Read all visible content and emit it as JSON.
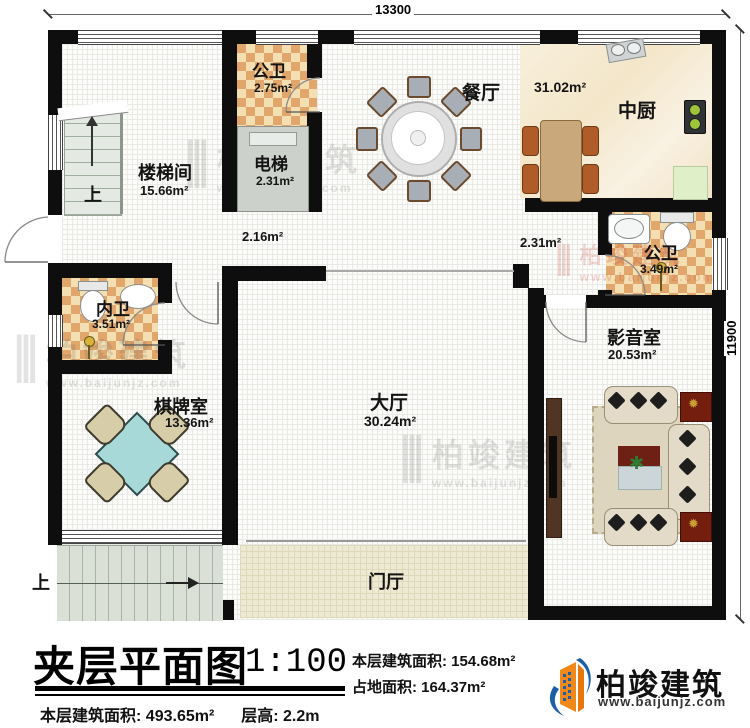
{
  "plan": {
    "dim_top": "13300",
    "dim_right": "11900",
    "up_label": "上",
    "rooms": [
      {
        "name": "楼梯间",
        "area": "15.66m²"
      },
      {
        "name": "公卫",
        "area": "2.75m²"
      },
      {
        "name": "电梯",
        "area": "2.31m²"
      },
      {
        "name": "餐厅",
        "area": "31.02m²"
      },
      {
        "name": "中厨",
        "area": ""
      },
      {
        "name": "",
        "area": "2.16m²"
      },
      {
        "name": "",
        "area": "2.31m²"
      },
      {
        "name": "公卫",
        "area": "3.49m²"
      },
      {
        "name": "内卫",
        "area": "3.51m²"
      },
      {
        "name": "棋牌室",
        "area": "13.36m²"
      },
      {
        "name": "大厅",
        "area": "30.24m²"
      },
      {
        "name": "影音室",
        "area": "20.53m²"
      },
      {
        "name": "门厅",
        "area": ""
      }
    ]
  },
  "watermark": {
    "text": "柏竣建筑",
    "url": "www.baijunjz.com"
  },
  "footer": {
    "title": "夹层平面图",
    "scale": "1:100",
    "floor_area_label": "本层建筑面积:",
    "floor_area_value": "154.68m²",
    "site_area_label": "占地面积:",
    "site_area_value": "164.37m²",
    "total_area_label": "本层建筑面积:",
    "total_area_value": "493.65m²",
    "height_label": "层高:",
    "height_value": "2.2m"
  },
  "brand": {
    "name": "柏竣建筑",
    "url": "www.baijunjz.com"
  }
}
